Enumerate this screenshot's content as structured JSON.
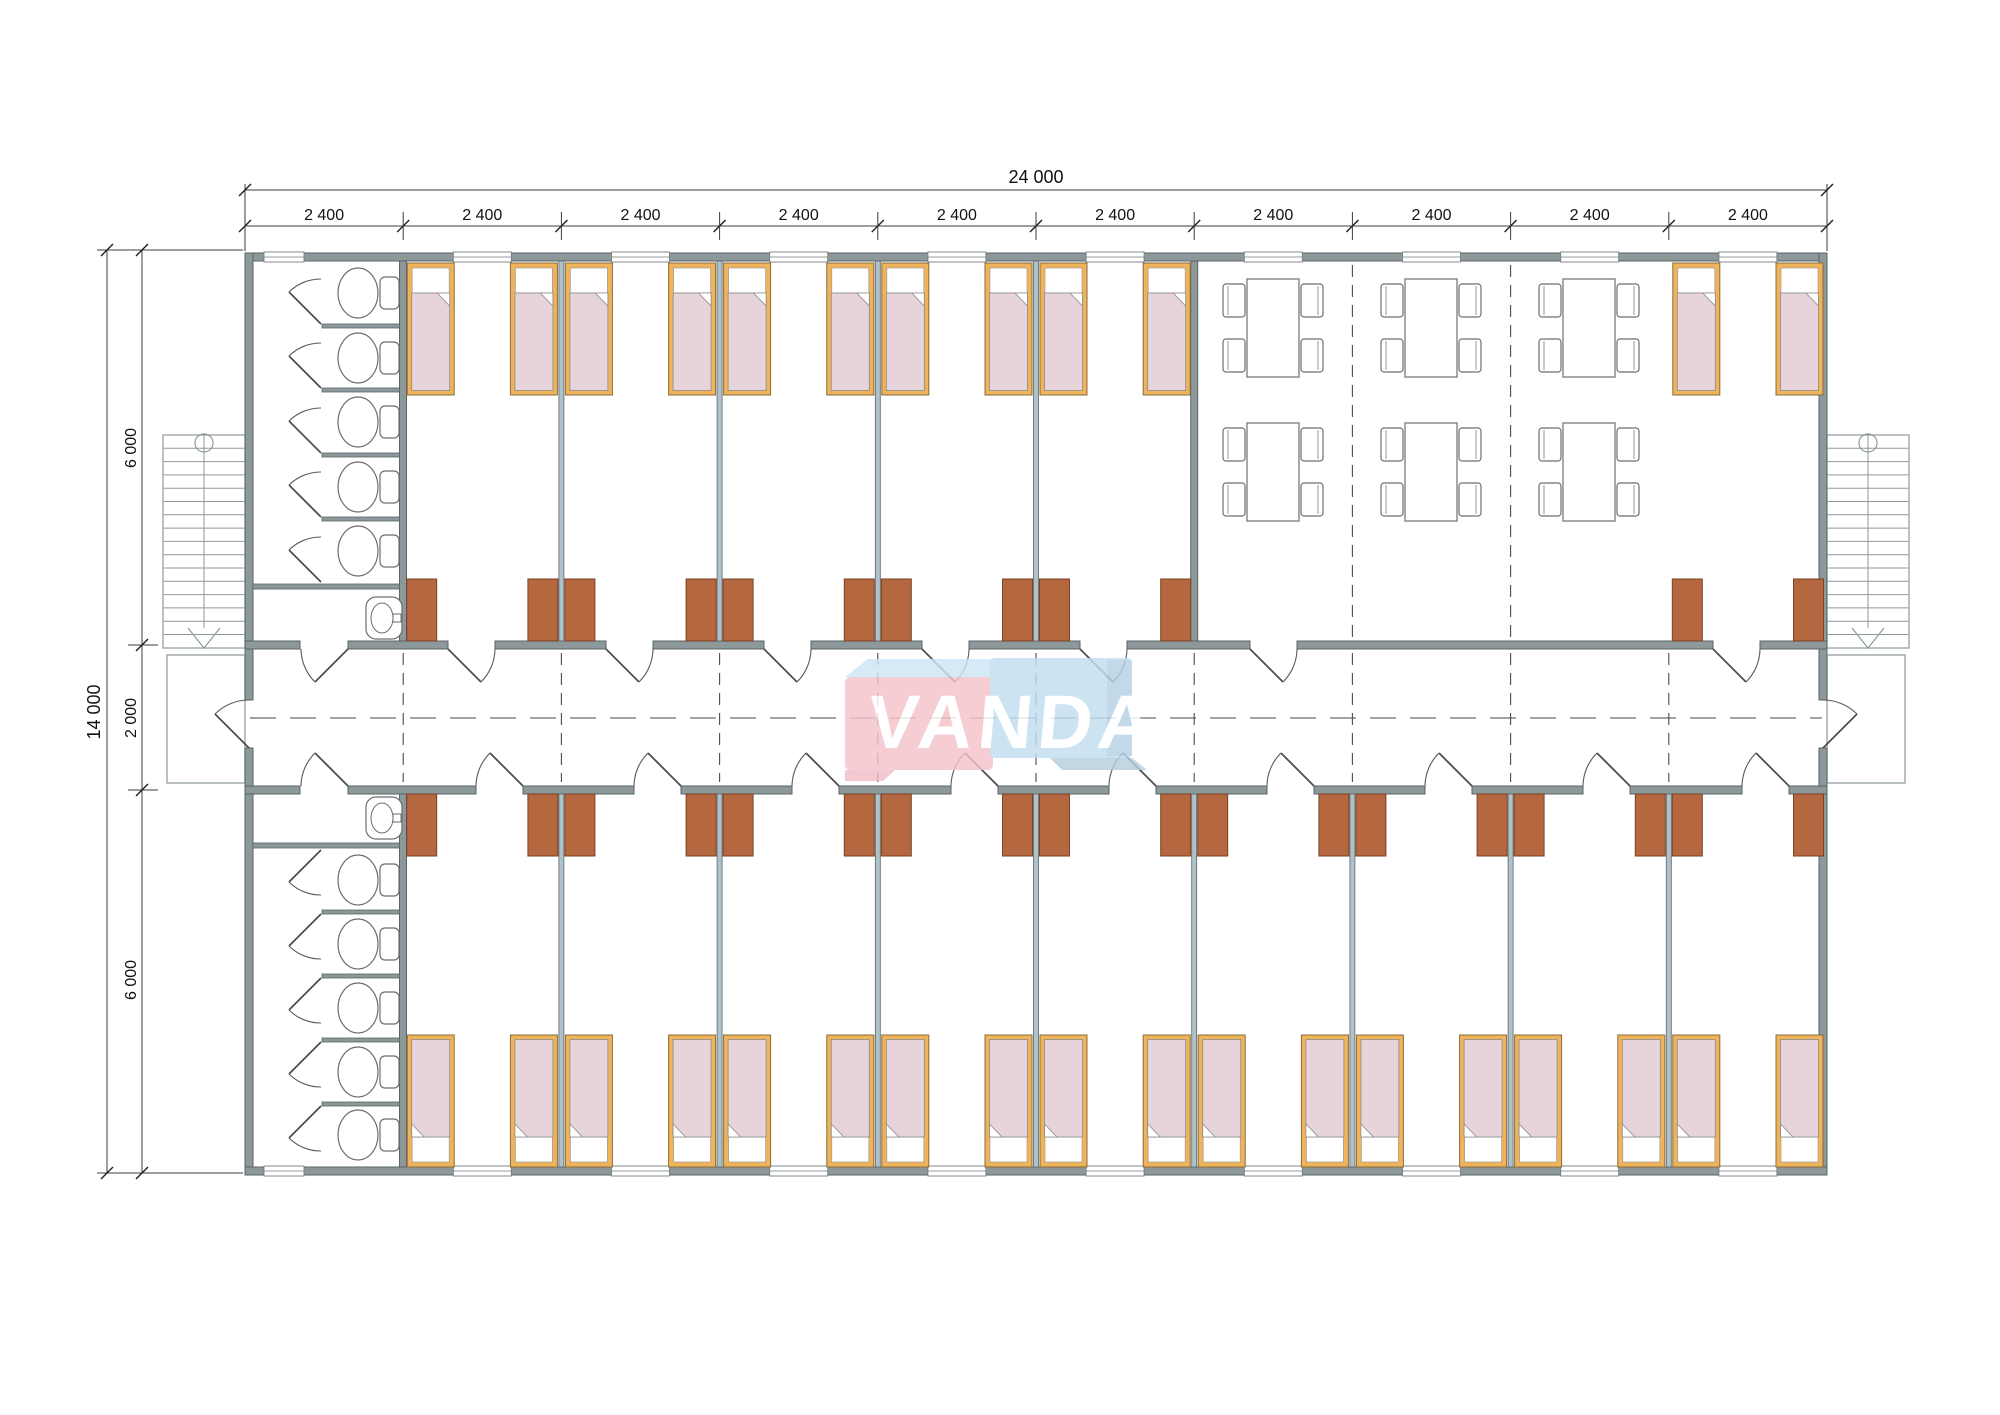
{
  "drawing": {
    "brand_watermark": "VANDA"
  },
  "dimensions": {
    "total_width_label": "24 000",
    "module_label": "2 400",
    "module_count": 10,
    "total_height_label": "14 000",
    "upper_wing_label": "6 000",
    "corridor_label": "2 000",
    "lower_wing_label": "6 000"
  },
  "elements": {
    "bedrooms_top_row": 6,
    "bedrooms_bottom_row": 9,
    "beds": 30,
    "wardrobes": 30,
    "toilet_stalls": 10,
    "sinks": 2,
    "dining_tables": 6,
    "chairs": 24,
    "staircases": 2,
    "entrance_porches": 2
  },
  "colors": {
    "wall": "#8D989B",
    "partition": "#AFC2C9",
    "wardrobe": "#B5673F",
    "bed_frame": "#EFB459",
    "bed_blanket": "#E6D4DA",
    "logo_pink": "#F5C3CA",
    "logo_blue": "#C2DEF0",
    "logo_text": "#FFFFFF",
    "line": "#3C3C3C",
    "background": "#FFFFFF"
  }
}
